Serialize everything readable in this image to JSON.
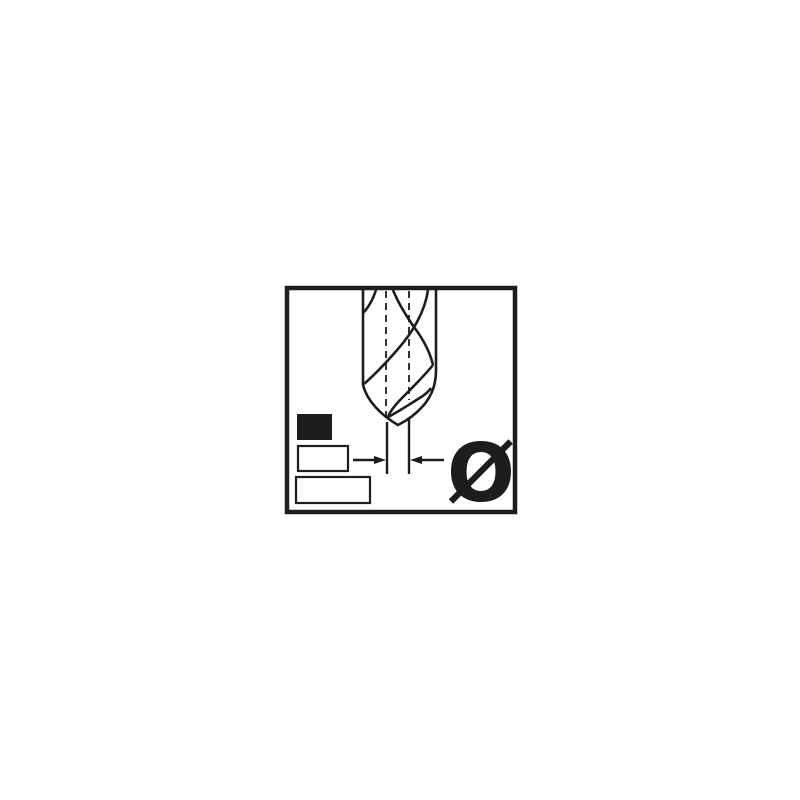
{
  "figure": {
    "description": "Technical pictogram of a twist drill bit tip with its point diameter dimensioned by inward-pointing arrows",
    "symbol": "Ø",
    "colors": {
      "ink": "#1d1d1b",
      "background": "#ffffff"
    },
    "elements": {
      "frame": "square border",
      "drill": "twist drill with helical flutes and conical point",
      "centerlines": "two dashed vertical lines",
      "dimension": "inward arrows on extension lines below the point",
      "swatches": [
        "filled rectangle",
        "outlined rectangle small",
        "outlined rectangle large"
      ]
    }
  }
}
